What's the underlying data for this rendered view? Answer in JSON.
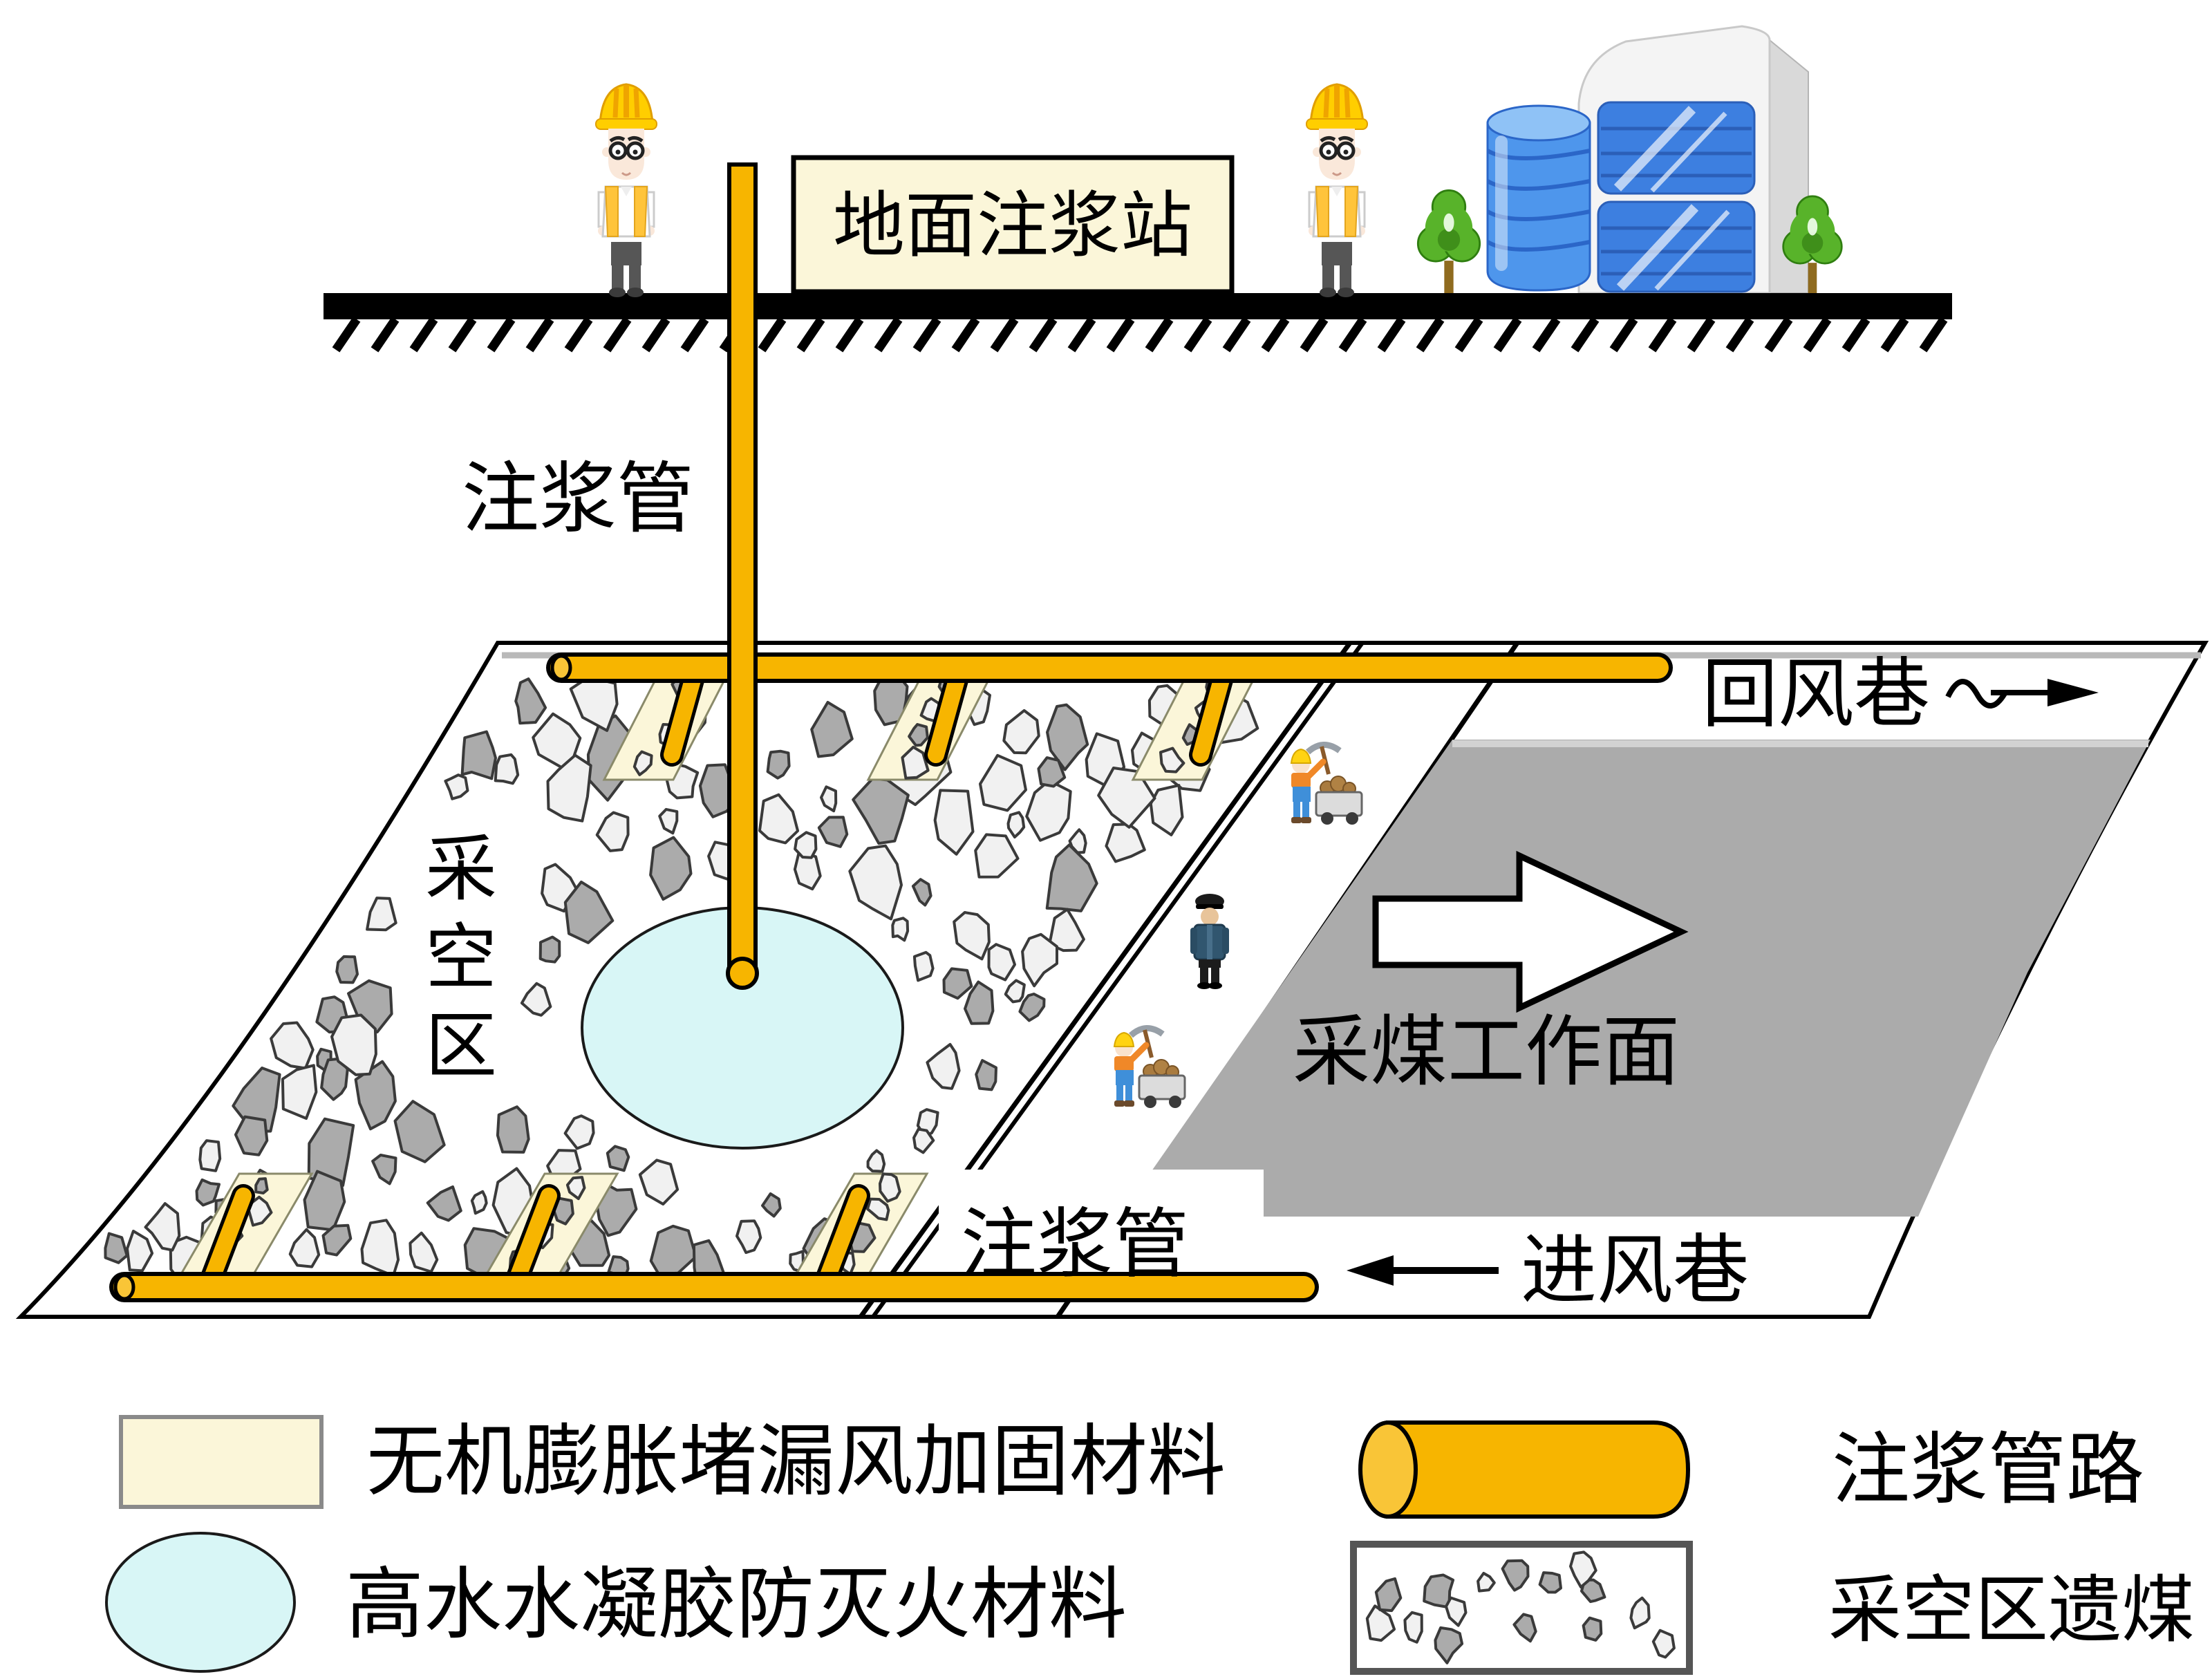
{
  "surface": {
    "station_label": "地面注浆站"
  },
  "labels": {
    "grout_pipe_top": "注浆管",
    "grout_pipe_bottom": "注浆管",
    "goaf_char_1": "采",
    "goaf_char_2": "空",
    "goaf_char_3": "区",
    "return_airway": "回风巷",
    "intake_airway": "进风巷",
    "working_face": "采煤工作面"
  },
  "legend": {
    "items": [
      {
        "symbol": "cream-rectangle",
        "label": "无机膨胀堵漏风加固材料"
      },
      {
        "symbol": "cyan-ellipse",
        "label": "高水水凝胶防灭火材料"
      },
      {
        "symbol": "orange-pipe-cylinder",
        "label": "注浆管路"
      },
      {
        "symbol": "goaf-rock-pattern",
        "label": "采空区遗煤"
      }
    ]
  },
  "colors": {
    "pipe_orange": "#F7B500",
    "pipe_orange_light": "#F9C537",
    "material_cream": "#FBF6D9",
    "gel_cyan": "#D8F6F6",
    "working_face_gray": "#ABABAB",
    "rock_gray": "#ABABAB",
    "rock_light": "#F1F1F1"
  }
}
